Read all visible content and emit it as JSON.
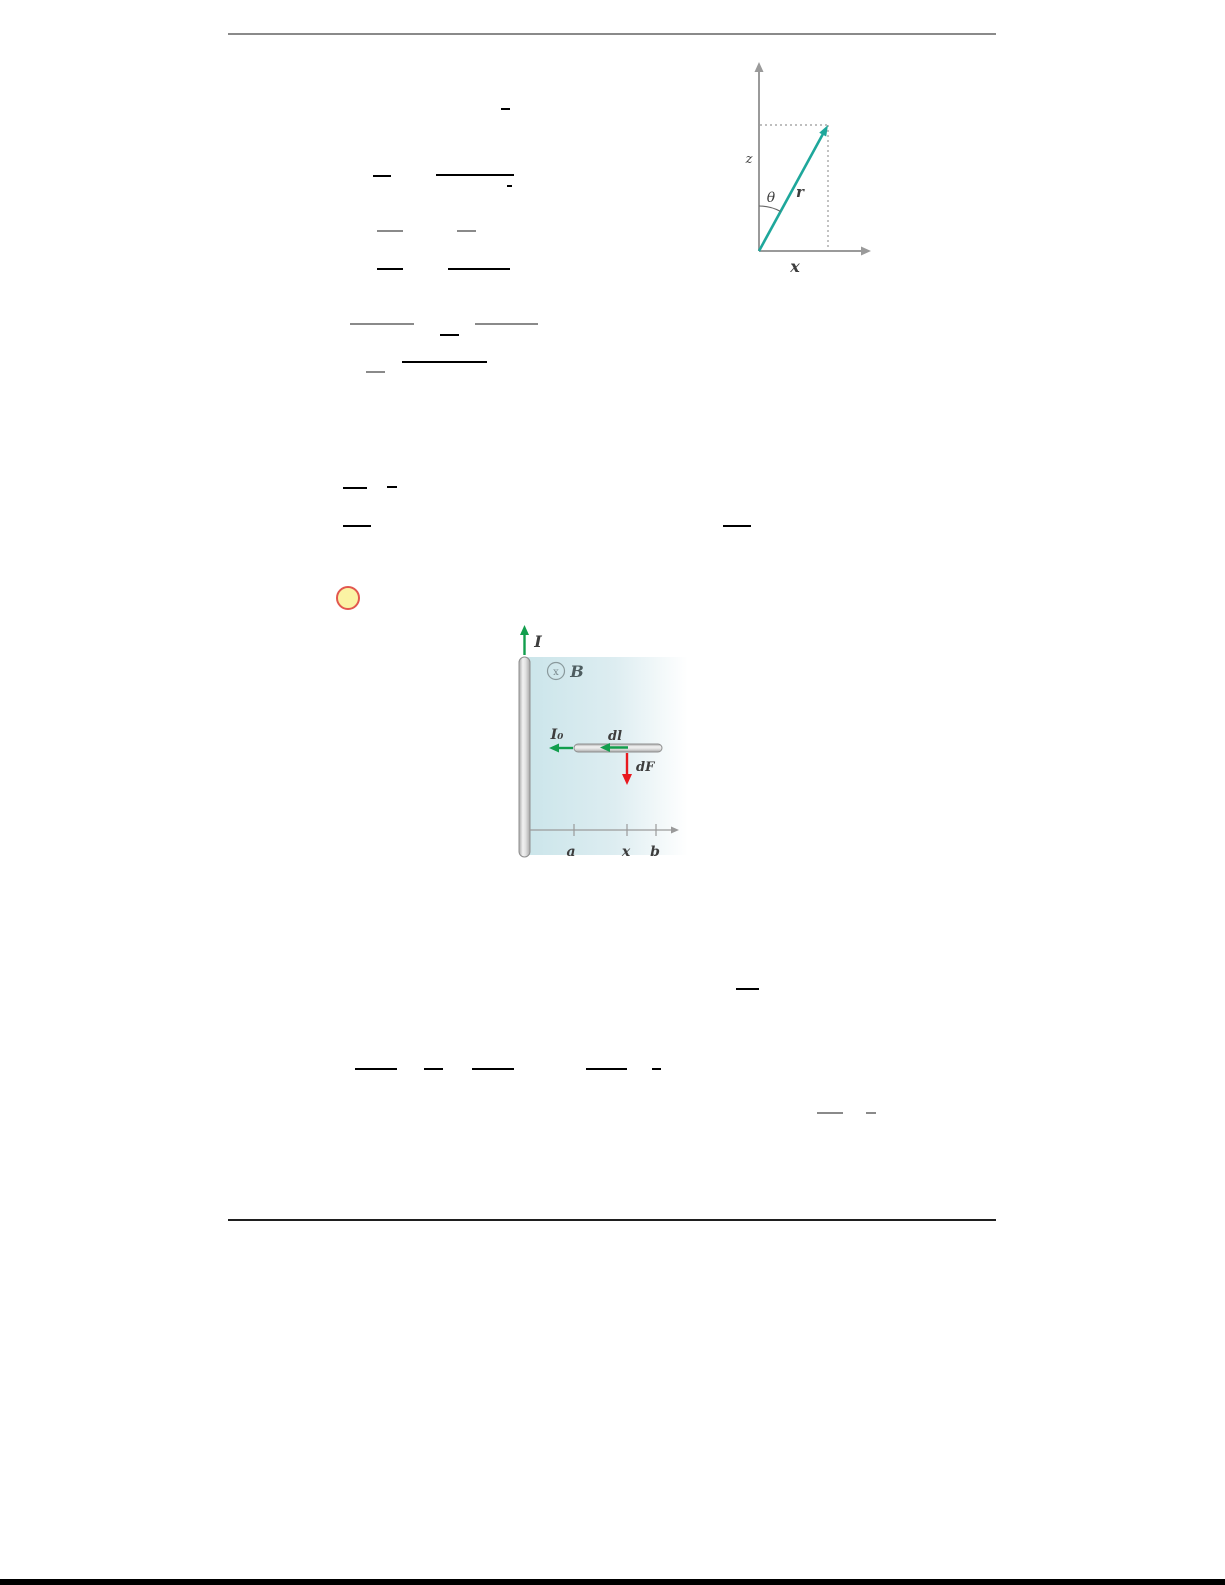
{
  "theme": {
    "page-bg": "#ffffff",
    "rule-gray": "#8a8a8a",
    "rule-dark": "#1f1f1f",
    "footer-black": "#000000",
    "bar-black": "#000000",
    "bar-gray": "#8a8a8a",
    "bullet-fill": "#fbf3a4",
    "bullet-border": "#e2574e",
    "axis-gray": "#9a9a9a",
    "dotted-gray": "#a8a8a8",
    "vector-teal": "#1ea79b",
    "arrow-green": "#129e4d",
    "arrow-red": "#e8191f",
    "label-dark": "#3d3d3d",
    "label-gray": "#4e5d60",
    "field-symbol-gray": "#7a8a8e",
    "metal-outline": "#8f8f8f",
    "shade-teal": "#cbe5ea"
  },
  "vector_diagram": {
    "z_label": "z",
    "theta_label": "θ",
    "r_label": "r",
    "x_label": "x"
  },
  "field_diagram": {
    "wire_current_label": "I",
    "field_label": "B",
    "field_symbol": "x",
    "rod_current_label": "I₀",
    "dl_label": "dl",
    "dF_label": "dF",
    "tick_a_label": "a",
    "tick_x_label": "x",
    "tick_b_label": "b"
  },
  "equation_bars": [
    {
      "x": 501,
      "y": 108,
      "w": 9,
      "shade": "black"
    },
    {
      "x": 373,
      "y": 175,
      "w": 18,
      "shade": "black"
    },
    {
      "x": 436,
      "y": 174,
      "w": 78,
      "shade": "black"
    },
    {
      "x": 507,
      "y": 185,
      "w": 5,
      "shade": "black"
    },
    {
      "x": 377,
      "y": 230,
      "w": 26,
      "shade": "gray"
    },
    {
      "x": 457,
      "y": 230,
      "w": 19,
      "shade": "gray"
    },
    {
      "x": 377,
      "y": 268,
      "w": 26,
      "shade": "black"
    },
    {
      "x": 448,
      "y": 268,
      "w": 62,
      "shade": "black"
    },
    {
      "x": 350,
      "y": 323,
      "w": 64,
      "shade": "gray"
    },
    {
      "x": 475,
      "y": 323,
      "w": 63,
      "shade": "gray"
    },
    {
      "x": 440,
      "y": 334,
      "w": 19,
      "shade": "black"
    },
    {
      "x": 402,
      "y": 361,
      "w": 85,
      "shade": "black"
    },
    {
      "x": 366,
      "y": 371,
      "w": 19,
      "shade": "gray"
    },
    {
      "x": 343,
      "y": 487,
      "w": 24,
      "shade": "black"
    },
    {
      "x": 387,
      "y": 486,
      "w": 10,
      "shade": "black"
    },
    {
      "x": 343,
      "y": 525,
      "w": 28,
      "shade": "black"
    },
    {
      "x": 723,
      "y": 525,
      "w": 28,
      "shade": "black"
    },
    {
      "x": 736,
      "y": 988,
      "w": 23,
      "shade": "black"
    },
    {
      "x": 355,
      "y": 1068,
      "w": 42,
      "shade": "black"
    },
    {
      "x": 424,
      "y": 1068,
      "w": 19,
      "shade": "black"
    },
    {
      "x": 472,
      "y": 1068,
      "w": 42,
      "shade": "black"
    },
    {
      "x": 586,
      "y": 1068,
      "w": 41,
      "shade": "black"
    },
    {
      "x": 652,
      "y": 1068,
      "w": 9,
      "shade": "black"
    },
    {
      "x": 817,
      "y": 1112,
      "w": 26,
      "shade": "gray"
    },
    {
      "x": 866,
      "y": 1112,
      "w": 10,
      "shade": "gray"
    }
  ]
}
